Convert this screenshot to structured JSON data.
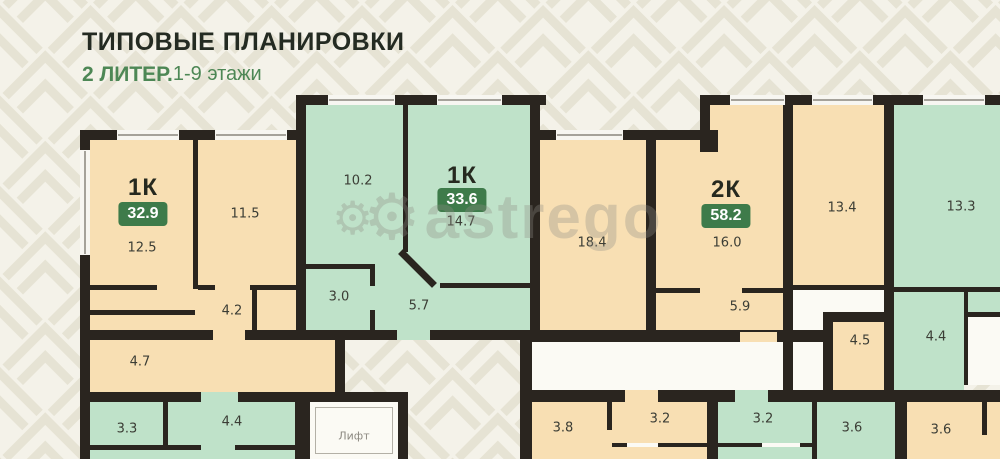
{
  "header": {
    "title": "ТИПОВЫЕ ПЛАНИРОВКИ",
    "block": "2 ЛИТЕР.",
    "floors": "1-9 этажи"
  },
  "watermark": {
    "text": "astrego",
    "gear_icon": "⚙"
  },
  "colors": {
    "room_peach": "#f8dfb3",
    "room_green": "#bfe2c9",
    "wall": "#2a251f",
    "badge_green": "#3e7b4a",
    "accent_green": "#4d8755",
    "background": "#f4f2e9"
  },
  "apartments": {
    "a1": {
      "type": "1К",
      "area": "32.9"
    },
    "a2": {
      "type": "1К",
      "area": "33.6"
    },
    "a3": {
      "type": "2К",
      "area": "58.2"
    }
  },
  "rooms": {
    "apt1_living": "12.5",
    "apt1_bedroom": "11.5",
    "apt1_hall": "4.2",
    "apt1_bath": "4.7",
    "apt2_room1": "10.2",
    "apt2_room2": "14.7",
    "apt2_bath": "3.0",
    "apt2_hall": "5.7",
    "apt3_living": "18.4",
    "apt3_bedroom": "16.0",
    "apt3_hall": "5.9",
    "right_room1": "13.4",
    "right_bath1": "4.5",
    "right_room2": "13.3",
    "right_bath2": "4.4",
    "bottomleft_room1": "3.3",
    "bottomleft_room2": "4.4",
    "bottomright_1": "3.8",
    "bottomright_2": "3.2",
    "bottomright_3": "3.2",
    "bottomright_4": "3.6",
    "bottomright_5": "3.6",
    "lift": "Лифт"
  }
}
